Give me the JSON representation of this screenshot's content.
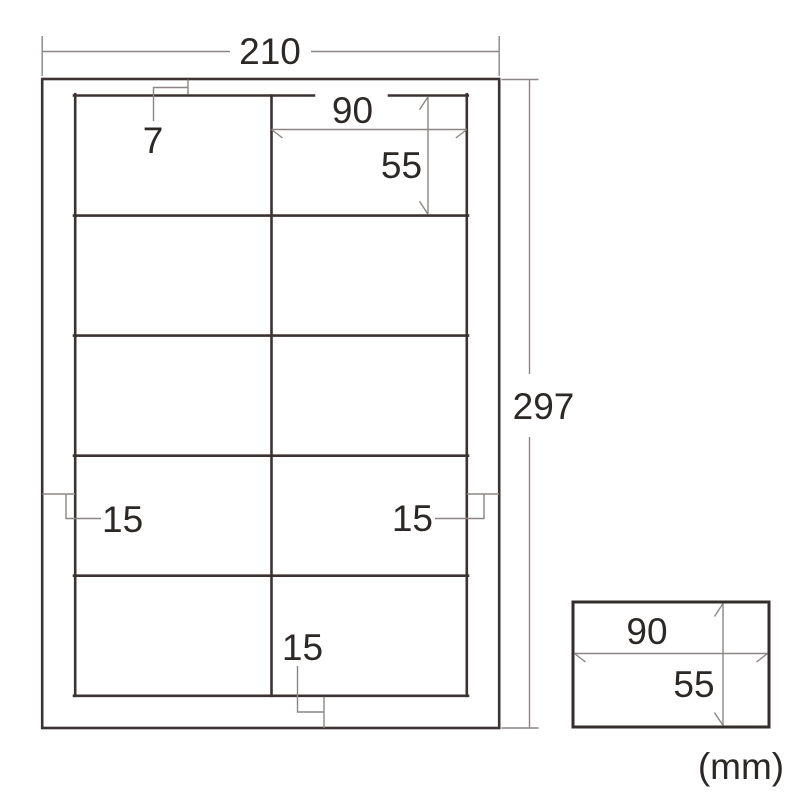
{
  "diagram": {
    "title": "label-sheet-dimension-diagram",
    "unit_note": "(mm)",
    "sheet": {
      "width": "210",
      "height": "297",
      "top_margin": "7",
      "left_margin": "15",
      "right_margin": "15",
      "bottom_margin": "15"
    },
    "grid": {
      "rows": 5,
      "columns": 2
    },
    "label_cell": {
      "width": "90",
      "height": "55"
    },
    "detail_label": {
      "width": "90",
      "height": "55"
    },
    "colors": {
      "outline": "#3a3331",
      "dimension_line": "#8b8683",
      "text": "#2c2826",
      "background": "#ffffff"
    }
  }
}
